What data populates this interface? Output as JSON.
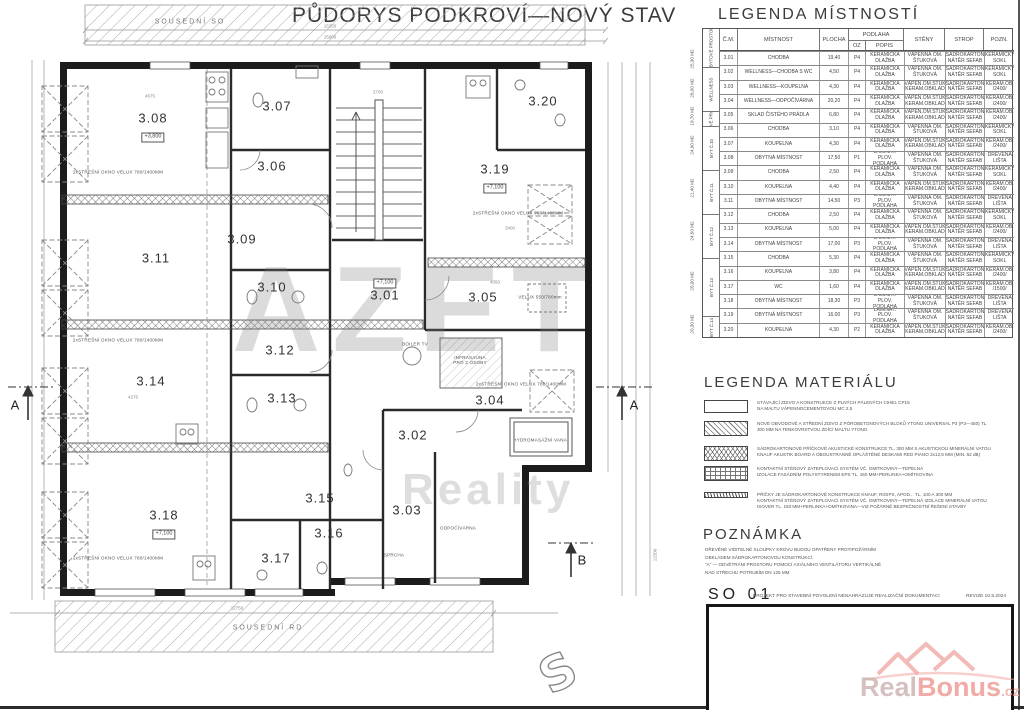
{
  "page": {
    "title": "PŮDORYS PODKROVÍ—NOVÝ STAV",
    "so_number": "SO 01",
    "so_text": "PROJEKT PRO STAVEBNÍ POVOLENÍ NENAHRAZUJE REALIZAČNÍ DOKUMENTACI",
    "so_revize": "REVIZE 10.5.2024"
  },
  "plan": {
    "neighbors": {
      "top": "SOUSEDNÍ SO",
      "bottom": "SOUSEDNÍ RD"
    },
    "roof_window_label": "2xSTŘEŠNÍ OKNO VELUX 780/1400MM",
    "annotations": {
      "infrasauna": "INFRASAUNA\nPRO 2 OSOBY",
      "vana": "HYDROMASÁŽNÍ VANA",
      "odpocivarna": "ODPOČÍVÁRNA",
      "sprcha": "SPRCHA",
      "boiler": "BOILER TV",
      "velux550": "VELUX 550/780mm"
    },
    "sections": {
      "a_left": "A",
      "a_right": "A",
      "b": "B"
    },
    "dims": {
      "top1": "15250",
      "top2": "15000",
      "bottom": "12750",
      "right": "12200",
      "d1": "4675",
      "d2": "2700",
      "d3": "4050",
      "d4": "4275",
      "d5": "3400"
    },
    "rooms": [
      {
        "id": "3.08",
        "level": "+3,800"
      },
      {
        "id": "3.07"
      },
      {
        "id": "3.06"
      },
      {
        "id": "3.19",
        "level": "+7,100"
      },
      {
        "id": "3.20"
      },
      {
        "id": "3.09"
      },
      {
        "id": "3.11"
      },
      {
        "id": "3.10"
      },
      {
        "id": "3.01",
        "level": "+7,100"
      },
      {
        "id": "3.05"
      },
      {
        "id": "3.12"
      },
      {
        "id": "3.14"
      },
      {
        "id": "3.13"
      },
      {
        "id": "3.04"
      },
      {
        "id": "3.02"
      },
      {
        "id": "3.03"
      },
      {
        "id": "3.18",
        "level": "+7,100"
      },
      {
        "id": "3.15"
      },
      {
        "id": "3.16"
      },
      {
        "id": "3.17"
      }
    ],
    "watermark": {
      "line1": "AZET",
      "line2": "Reality"
    }
  },
  "legend_rooms": {
    "title": "LEGENDA MÍSTNOSTÍ",
    "headers": {
      "cm": "Č.M.",
      "mistnost": "MÍSTNOST",
      "plocha": "PLOCHA",
      "podlaha": "PODLAHA",
      "oz": "OZ",
      "popis": "POPIS",
      "steny": "STĚNY",
      "strop": "STROP",
      "pozn": "POZN."
    },
    "groups": [
      {
        "area": "25,30 M2",
        "name": "NEBYTOVÉ PROSTORY"
      },
      {
        "area": "28,00 M2",
        "name": "WELLNESS"
      },
      {
        "area": "19,70 M2",
        "name": "NEBYTOVÉ PROSTORY"
      },
      {
        "area": "24,90 M2",
        "name": "BYT Č.10"
      },
      {
        "area": "21,40 M2",
        "name": "BYT Č.11"
      },
      {
        "area": "24,50 M2",
        "name": "BYT Č.12"
      },
      {
        "area": "25,00 M2",
        "name": "BYT Č.13"
      },
      {
        "area": "20,30 M2",
        "name": "BYT Č.14"
      }
    ],
    "rows": [
      {
        "cm": "3.01",
        "mistnost": "CHODBA",
        "plocha": "19,40",
        "oz": "P4",
        "popis": "KERAMICKÁ\nDLAŽBA",
        "steny": "VÁPENNÁ OM.\nŠTUKOVÁ",
        "strop": "SÁDROKARTON\nNÁTĚR SEFAB",
        "pozn": "KERAMICKÝ\nSOKL"
      },
      {
        "cm": "3.02",
        "mistnost": "WELLNESS—CHODBA S WC",
        "plocha": "4,50",
        "oz": "P4",
        "popis": "KERAMICKÁ\nDLAŽBA",
        "steny": "VÁPENNÁ OM.\nŠTUKOVÁ",
        "strop": "SÁDROKARTON\nNÁTĚR SEFAB",
        "pozn": "KERAMICKÝ\nSOKL"
      },
      {
        "cm": "3.03",
        "mistnost": "WELLNESS—KOUPELNA",
        "plocha": "4,30",
        "oz": "P4",
        "popis": "KERAMICKÁ\nDLAŽBA",
        "steny": "VÁPEN.OM.ŠTUK\nKERAM.OBKLAD",
        "strop": "SÁDROKARTON\nNÁTĚR SEFAB",
        "pozn": "KERAM.OB.\n/2400/"
      },
      {
        "cm": "3.04",
        "mistnost": "WELLNESS—ODPOČÍVÁRNA",
        "plocha": "20,20",
        "oz": "P4",
        "popis": "KERAMICKÁ\nDLAŽBA",
        "steny": "VÁPEN.OM.ŠTUK\nKERAM.OBKLAD",
        "strop": "SÁDROKARTON\nNÁTĚR SEFAB",
        "pozn": "KERAM.OB.\n/2400/"
      },
      {
        "cm": "3.05",
        "mistnost": "SKLAD ČISTÉHO PRÁDLA",
        "plocha": "6,80",
        "oz": "P4",
        "popis": "KERAMICKÁ\nDLAŽBA",
        "steny": "VÁPEN.OM.ŠTUK\nKERAM.OBKLAD",
        "strop": "SÁDROKARTON\nNÁTĚR SEFAB",
        "pozn": "KERAM.OB.\n/2400/"
      },
      {
        "cm": "3.06",
        "mistnost": "CHODBA",
        "plocha": "3,10",
        "oz": "P4",
        "popis": "KERAMICKÁ\nDLAŽBA",
        "steny": "VÁPENNÁ OM.\nŠTUKOVÁ",
        "strop": "SÁDROKARTON\nNÁTĚR SEFAB",
        "pozn": "KERAMICKÝ\nSOKL"
      },
      {
        "cm": "3.07",
        "mistnost": "KOUPELNA",
        "plocha": "4,30",
        "oz": "P4",
        "popis": "KERAMICKÁ\nDLAŽBA",
        "steny": "VÁPEN.OM.ŠTUK\nKERAM.OBKLAD",
        "strop": "SÁDROKARTON\nNÁTĚR SEFAB",
        "pozn": "KERAM.OB.\n/2400/"
      },
      {
        "cm": "3.08",
        "mistnost": "OBYTNÁ MÍSTNOST",
        "plocha": "17,50",
        "oz": "P1",
        "popis": "LAMINÁT. PLOV.\nPODLAHA",
        "steny": "VÁPENNÁ OM.\nŠTUKOVÁ",
        "strop": "SÁDROKARTON\nNÁTĚR SEFAB",
        "pozn": "DŘEVĚNÁ\nLIŠTA"
      },
      {
        "cm": "3.09",
        "mistnost": "CHODBA",
        "plocha": "2,50",
        "oz": "P4",
        "popis": "KERAMICKÁ\nDLAŽBA",
        "steny": "VÁPENNÁ OM.\nŠTUKOVÁ",
        "strop": "SÁDROKARTON\nNÁTĚR SEFAB",
        "pozn": "KERAMICKÝ\nSOKL"
      },
      {
        "cm": "3.10",
        "mistnost": "KOUPELNA",
        "plocha": "4,40",
        "oz": "P4",
        "popis": "KERAMICKÁ\nDLAŽBA",
        "steny": "VÁPEN.OM.ŠTUK\nKERAM.OBKLAD",
        "strop": "SÁDROKARTON\nNÁTĚR SEFAB",
        "pozn": "KERAM.OB.\n/2400/"
      },
      {
        "cm": "3.11",
        "mistnost": "OBYTNÁ MÍSTNOST",
        "plocha": "14,50",
        "oz": "P3",
        "popis": "LAMINÁT. PLOV.\nPODLAHA",
        "steny": "VÁPENNÁ OM.\nŠTUKOVÁ",
        "strop": "SÁDROKARTON\nNÁTĚR SEFAB",
        "pozn": "DŘEVĚNÁ\nLIŠTA"
      },
      {
        "cm": "3.12",
        "mistnost": "CHODBA",
        "plocha": "2,50",
        "oz": "P4",
        "popis": "KERAMICKÁ\nDLAŽBA",
        "steny": "VÁPENNÁ OM.\nŠTUKOVÁ",
        "strop": "SÁDROKARTON\nNÁTĚR SEFAB",
        "pozn": "KERAMICKÝ\nSOKL"
      },
      {
        "cm": "3.13",
        "mistnost": "KOUPELNA",
        "plocha": "5,00",
        "oz": "P4",
        "popis": "KERAMICKÁ\nDLAŽBA",
        "steny": "VÁPEN.OM.ŠTUK\nKERAM.OBKLAD",
        "strop": "SÁDROKARTON\nNÁTĚR SEFAB",
        "pozn": "KERAM.OB.\n/2400/"
      },
      {
        "cm": "3.14",
        "mistnost": "OBYTNÁ MÍSTNOST",
        "plocha": "17,00",
        "oz": "P3",
        "popis": "LAMINÁT. PLOV.\nPODLAHA",
        "steny": "VÁPENNÁ OM.\nŠTUKOVÁ",
        "strop": "SÁDROKARTON\nNÁTĚR SEFAB",
        "pozn": "DŘEVĚNÁ\nLIŠTA"
      },
      {
        "cm": "3.15",
        "mistnost": "CHODBA",
        "plocha": "5,30",
        "oz": "P4",
        "popis": "KERAMICKÁ\nDLAŽBA",
        "steny": "VÁPENNÁ OM.\nŠTUKOVÁ",
        "strop": "SÁDROKARTON\nNÁTĚR SEFAB",
        "pozn": "KERAMICKÝ\nSOKL"
      },
      {
        "cm": "3.16",
        "mistnost": "KOUPELNA",
        "plocha": "3,80",
        "oz": "P4",
        "popis": "KERAMICKÁ\nDLAŽBA",
        "steny": "VÁPEN.OM.ŠTUK\nKERAM.OBKLAD",
        "strop": "SÁDROKARTON\nNÁTĚR SEFAB",
        "pozn": "KERAM.OB.\n/2400/"
      },
      {
        "cm": "3.17",
        "mistnost": "WC",
        "plocha": "1,60",
        "oz": "P4",
        "popis": "KERAMICKÁ\nDLAŽBA",
        "steny": "VÁPEN.OM.ŠTUK\nKERAM.OBKLAD",
        "strop": "SÁDROKARTON\nNÁTĚR SEFAB",
        "pozn": "KERAM.OB.\n/1500/"
      },
      {
        "cm": "3.18",
        "mistnost": "OBYTNÁ MÍSTNOST",
        "plocha": "18,30",
        "oz": "P3",
        "popis": "LAMINÁT. PLOV.\nPODLAHA",
        "steny": "VÁPENNÁ OM.\nŠTUKOVÁ",
        "strop": "SÁDROKARTON\nNÁTĚR SEFAB",
        "pozn": "DŘEVĚNÁ\nLIŠTA"
      },
      {
        "cm": "3.19",
        "mistnost": "OBYTNÁ MÍSTNOST",
        "plocha": "16,00",
        "oz": "P3",
        "popis": "LAMINÁT. PLOV.\nPODLAHA",
        "steny": "VÁPENNÁ OM.\nŠTUKOVÁ",
        "strop": "SÁDROKARTON\nNÁTĚR SEFAB",
        "pozn": "DŘEVĚNÁ\nLIŠTA"
      },
      {
        "cm": "3.20",
        "mistnost": "KOUPELNA",
        "plocha": "4,30",
        "oz": "P2",
        "popis": "KERAMICKÁ\nDLAŽBA",
        "steny": "VÁPEN.OM.ŠTUK\nKERAM.OBKLAD",
        "strop": "SÁDROKARTON\nNÁTĚR SEFAB",
        "pozn": "KERAM.OB.\n/2400/"
      }
    ]
  },
  "legend_materials": {
    "title": "LEGENDA MATERIÁLU",
    "items": [
      {
        "text": "STÁVAJÍCÍ ZDIVO A KONSTRUKCE Z PLNÝCH PÁLENÝCH CIHEL CP15\nNA MALTU VÁPENNOCEMENTOVOU MC 2,5"
      },
      {
        "text": "NOVÉ OBVODOVÉ A STŘEDNÍ ZDIVO Z PÓROBETONOVÝCH BLOKŮ YTONG UNIVERSAL P3 (P3—450) TL.\n300 MM NA TENKOVRSTVOU ZDÍCÍ MALTU YTONG"
      },
      {
        "text": "SÁDROKARTONOVÉ PŘÍČKOVÉ AKUSTICKÉ KONSTRUKCE TL. 300 MM S AKUSTICKOU MINERÁLNÍ VATOU\nKNAUF AKUSTIK BOARD A OBOUSTRANNĚ OPLÁŠTĚNÉ DESKAMI RED PIANO 2x12,5 MM (MIN. 62 dB)"
      },
      {
        "text": "KONTAKTNÍ STĚNOVÝ ZATEPLOVACÍ SYSTÉM VČ. OMÍTKOVINY—TEPELNÁ\nIZOLACE FASÁDNÍM POLYSTYRENEM EPS TL. 150 MM+PERLINKA+OMÍTKOVINA"
      },
      {
        "text": "PŘÍČKY JE SÁDROKARTONOVÉ KONSTRUKCE KNAUF, RIGIPS, APOD... TL. 100 A 300 MM\nKONTAKTNÍ STĚNOVÝ ZATEPLOVACÍ SYSTÉM VČ. OMÍTKOVINY—TEPELNÁ IZOLACE MINERÁLNÍ VATOU\nISOVER TL. 150 MM+PERLINKA+OMÍTKOVINA—VIZ POŽÁRNĚ BEZPEČNOSTNÍ ŘEŠENÍ STAVBY"
      }
    ]
  },
  "note": {
    "title": "POZNÁMKA",
    "body": "DŘEVĚNÉ VIDITELNÉ SLOUPKY KROVU BUDOU OPATŘENY PROTIPOŽÁRNÍM\nOBKLADEM SÁDROKARTONOVOU KONSTRUKCÍ.\n\"A\" — ODVĚTRÁNÍ PROSTORU POMOCÍ AXIÁLNÍHO VENTILÁTORU VERTIKÁLNĚ\nNAD STŘECHU POTRUBÍM DN 125 MM"
  },
  "logo": {
    "real": "Real",
    "bonus": "Bonus",
    "cz": ".cz",
    "colors": {
      "real": "#c9b1af",
      "bonus": "#ee9690",
      "roof": "#f0aaa5"
    }
  }
}
